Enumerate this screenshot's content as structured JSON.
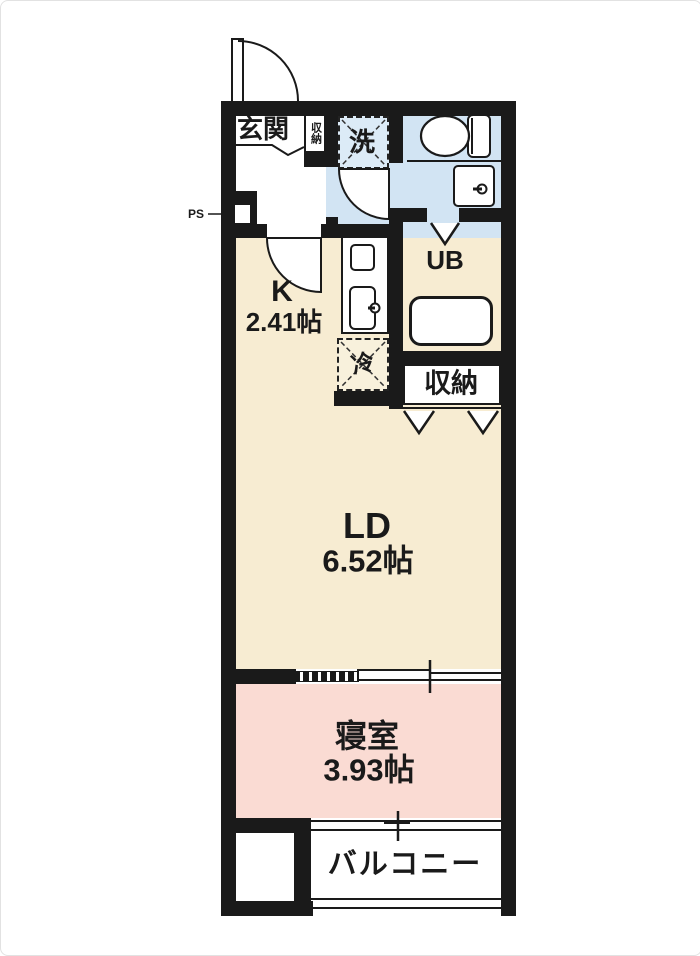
{
  "plan_title": "1K apartment floor plan",
  "rooms": {
    "genkan": {
      "label": "玄関"
    },
    "entrance_storage": {
      "label": "収納"
    },
    "laundry": {
      "label": "洗"
    },
    "ps": {
      "label": "PS"
    },
    "kitchen": {
      "label": "K",
      "size": "2.41帖"
    },
    "unit_bath": {
      "label": "UB"
    },
    "fridge": {
      "label": "冷"
    },
    "closet": {
      "label": "収納"
    },
    "living_dining": {
      "label": "LD",
      "size": "6.52帖"
    },
    "bedroom": {
      "label": "寝室",
      "size": "3.93帖"
    },
    "balcony": {
      "label": "バルコニー"
    }
  },
  "colors": {
    "wall": "#1a1a1a",
    "room_beige": "#f7ecd2",
    "room_pink": "#fadbd3",
    "room_blue": "#d2e4f3",
    "laundry_blue": "#dcebf7",
    "fridge_cream": "#f8f1dc"
  }
}
